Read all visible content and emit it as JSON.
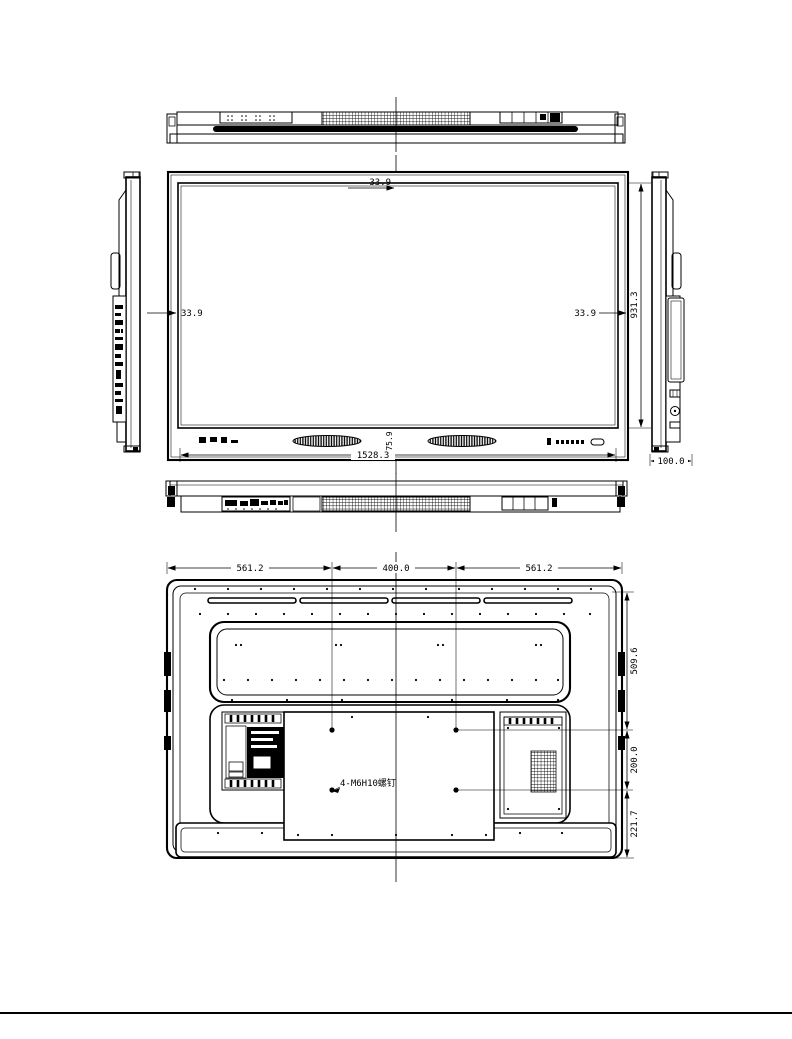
{
  "views": {
    "front": {
      "top_bezel": "33.9",
      "left_bezel": "33.9",
      "right_bezel": "33.9",
      "height": "931.3",
      "width": "1528.3",
      "bottom_bezel": "75.9"
    },
    "side": {
      "depth": "100.0"
    },
    "rear": {
      "left_span": "561.2",
      "vesa_width": "400.0",
      "right_span": "561.2",
      "top_to_vesa": "509.6",
      "vesa_height": "200.0",
      "vesa_to_bottom": "221.7",
      "screw_note": "4-M6H10螺钉"
    }
  }
}
